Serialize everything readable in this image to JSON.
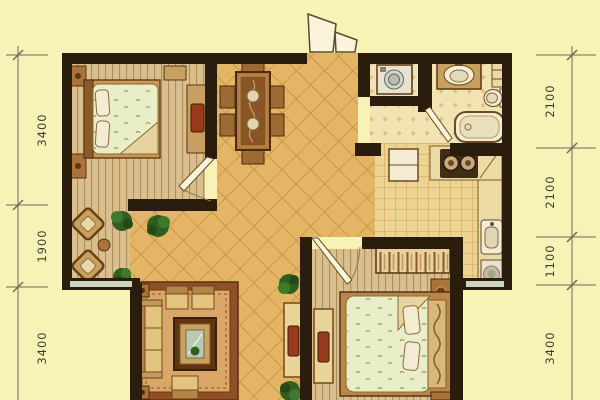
{
  "canvas": {
    "width": 600,
    "height": 400
  },
  "palette": {
    "background": "#f7f3b6",
    "wall": "#2b1d0e",
    "tile_floor": "#e3b565",
    "tile_line": "#be8e42",
    "wood_floor": "#d9bf8e",
    "wood_line": "#ad8f5c",
    "kitchen_floor": "#eed492",
    "kitchen_line": "#c9a055",
    "bath_floor": "#f2e4b2",
    "bath_dot": "#dcc27e",
    "rug": "#8f5026",
    "rug_inner": "#d9a868",
    "furniture_wood": "#a9733a",
    "wood_dark": "#5a3414",
    "sofa": "#e3c47e",
    "bedding": "#e9edc8",
    "plant": "#2f5d22",
    "fixture": "#f3ecd2",
    "counter": "#ecd9a4",
    "window": "#ccd5bd",
    "tv": "#993a1c",
    "door_leaf": "#faf5da",
    "dim_line": "#6b6b58",
    "dim_text": "#3a3a30"
  },
  "dimensions": {
    "left": [
      {
        "label": "3400"
      },
      {
        "label": "1900"
      },
      {
        "label": "3400"
      }
    ],
    "right": [
      {
        "label": "2100"
      },
      {
        "label": "2100"
      },
      {
        "label": "1100"
      },
      {
        "label": "3400"
      }
    ]
  }
}
